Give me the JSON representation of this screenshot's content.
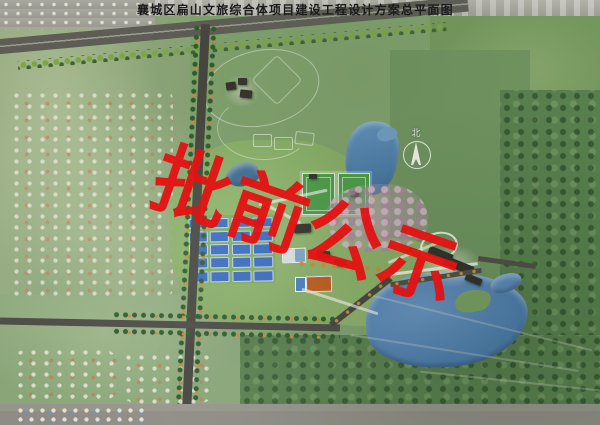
{
  "header": {
    "title": "襄城区扁山文旅综合体项目建设工程设计方案总平面图"
  },
  "watermark": {
    "text": "批前公示",
    "color": "#e41212"
  },
  "compass": {
    "north_label": "北"
  },
  "site": {
    "tennis_courts": {
      "rows": 5,
      "cols": 4
    },
    "football_pitches": 2,
    "colors": {
      "watermark_red": "#e41212",
      "court_blue": "#3a6cc2",
      "pitch_green": "#4c9c49",
      "lake_blue": "#4d7dae",
      "basketball_orange": "#c05a1e",
      "road_gray": "#45443e",
      "forest_green": "#587f4e"
    }
  }
}
